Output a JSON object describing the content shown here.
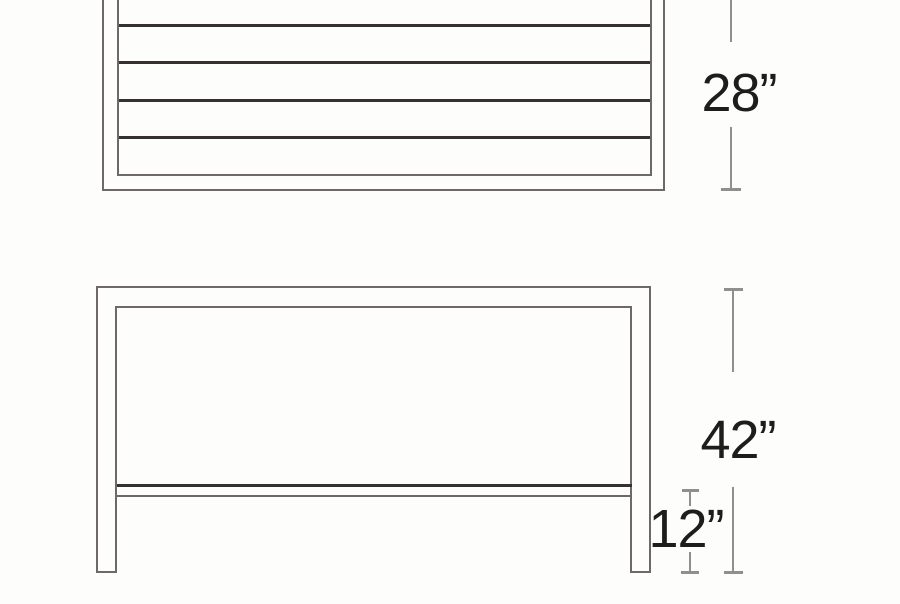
{
  "diagram": {
    "kind": "furniture-dimension-drawing",
    "views": {
      "top_view": {
        "name": "slatted-top-plan-view",
        "slat_line_count": 4
      },
      "front_view": {
        "name": "front-elevation-with-stretcher"
      }
    },
    "dimensions": {
      "top_depth": {
        "label": "28”"
      },
      "overall_height": {
        "label": "42”"
      },
      "stretcher_height": {
        "label": "12”"
      }
    },
    "colors": {
      "background": "#fdfdfc",
      "outline": "#6e6867",
      "slat": "#372f30",
      "dim": "#8d908f",
      "text": "#1d1d1b"
    }
  }
}
